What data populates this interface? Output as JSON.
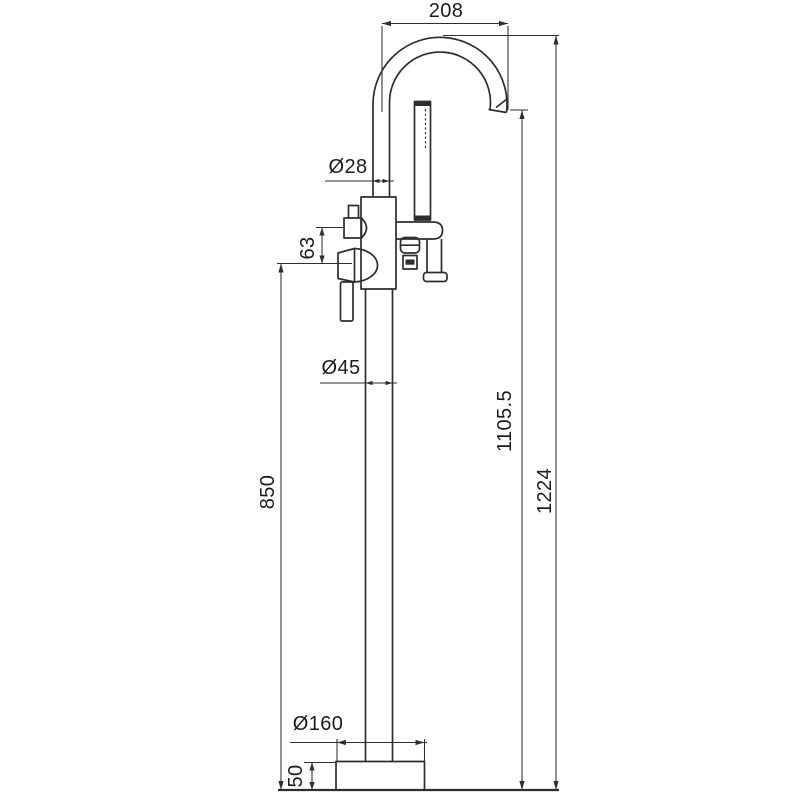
{
  "figure": {
    "type": "technical-dimension-drawing",
    "subject": "Freestanding bath mixer tap with gooseneck spout and hand shower, side elevation",
    "units": "mm"
  },
  "dimensions": {
    "spout_reach": "208",
    "spout_tube_diameter": "Ø28",
    "diverter_to_handle": "63",
    "riser_diameter": "Ø45",
    "handle_center_height": "850",
    "spout_outlet_height": "1105.5",
    "overall_height": "1224",
    "base_diameter": "Ø160",
    "base_height": "50"
  },
  "colors": {
    "line": "#2e2e2e",
    "text": "#1c1c1c",
    "background": "#ffffff"
  }
}
